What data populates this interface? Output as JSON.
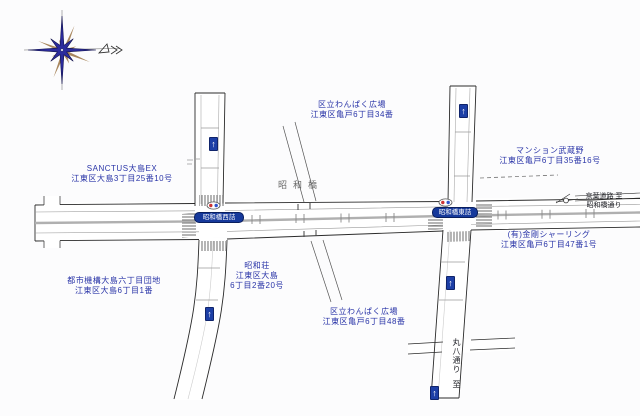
{
  "map": {
    "bridge_label": "昭和橋",
    "one_way_arrow": "↑",
    "intersection_badges": [
      {
        "name": "昭和橋西詰"
      },
      {
        "name": "昭和橋東詰"
      }
    ],
    "direction_labels": {
      "east_line1": "京葉道路 至",
      "east_line2": "昭和橋通り",
      "south_road": "丸八通り",
      "south_to": "至"
    },
    "places": [
      {
        "line1": "SANCTUS大島EX",
        "line2": "江東区大島3丁目25番10号"
      },
      {
        "line1": "区立わんぱく広場",
        "line2": "江東区亀戸6丁目34番"
      },
      {
        "line1": "マンション武蔵野",
        "line2": "江東区亀戸6丁目35番16号"
      },
      {
        "line1": "(有)金剛シャーリング",
        "line2": "江東区亀戸6丁目47番1号"
      },
      {
        "line1": "昭和荘",
        "line2": "江東区大島",
        "line3": "6丁目2番20号"
      },
      {
        "line1": "区立わんぱく広場",
        "line2": "江東区亀戸6丁目48番"
      },
      {
        "line1": "都市機構大島六丁目団地",
        "line2": "江東区大島6丁目1番"
      }
    ],
    "colors": {
      "label_blue": "#2a35a8",
      "badge_blue": "#16399b",
      "median_gray": "#b0b0b0",
      "compass_blue": "#2b2b9d",
      "compass_brown": "#a8875f"
    }
  }
}
